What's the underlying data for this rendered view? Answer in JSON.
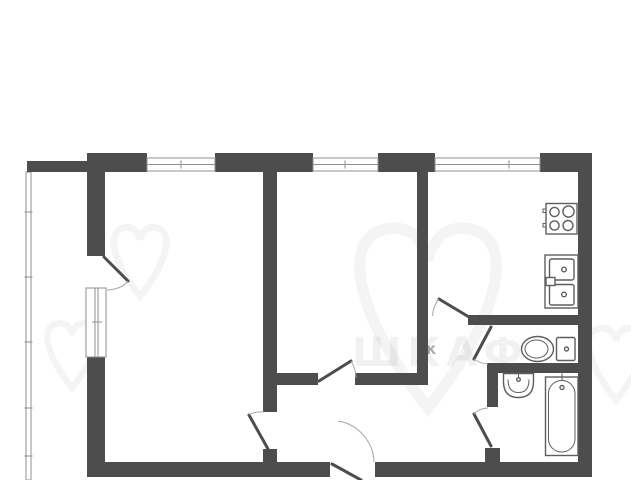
{
  "plan_type": "apartment-floor-plan",
  "colors": {
    "bg": "#ffffff",
    "wall": "#4d4d4d",
    "line": "#8f8f8f",
    "arc": "#a5a5a5",
    "fixture": "#5e5e5e",
    "wm_shape": "rgba(0,0,0,0.045)",
    "wm_text": "rgba(0,0,0,0.055)",
    "wm_small": "#a8a8a8"
  },
  "watermark": {
    "word": "ШКАФ",
    "small_letter": "к"
  },
  "rooms": [
    {
      "name": "living-room"
    },
    {
      "name": "bedroom"
    },
    {
      "name": "kitchen"
    },
    {
      "name": "wc"
    },
    {
      "name": "bathroom"
    },
    {
      "name": "hallway"
    },
    {
      "name": "balcony"
    }
  ],
  "fixtures": [
    {
      "name": "stove",
      "burners": 4
    },
    {
      "name": "kitchen-double-sink",
      "basins": 2
    },
    {
      "name": "toilet"
    },
    {
      "name": "wash-basin"
    },
    {
      "name": "bathtub"
    }
  ],
  "openings": [
    {
      "name": "window-living"
    },
    {
      "name": "window-bedroom"
    },
    {
      "name": "window-kitchen"
    },
    {
      "name": "window-balcony-wall"
    },
    {
      "name": "balcony-door"
    },
    {
      "name": "living-room-door"
    },
    {
      "name": "bedroom-door"
    },
    {
      "name": "kitchen-door"
    },
    {
      "name": "wc-door"
    },
    {
      "name": "bathroom-door"
    },
    {
      "name": "entry-door"
    }
  ]
}
